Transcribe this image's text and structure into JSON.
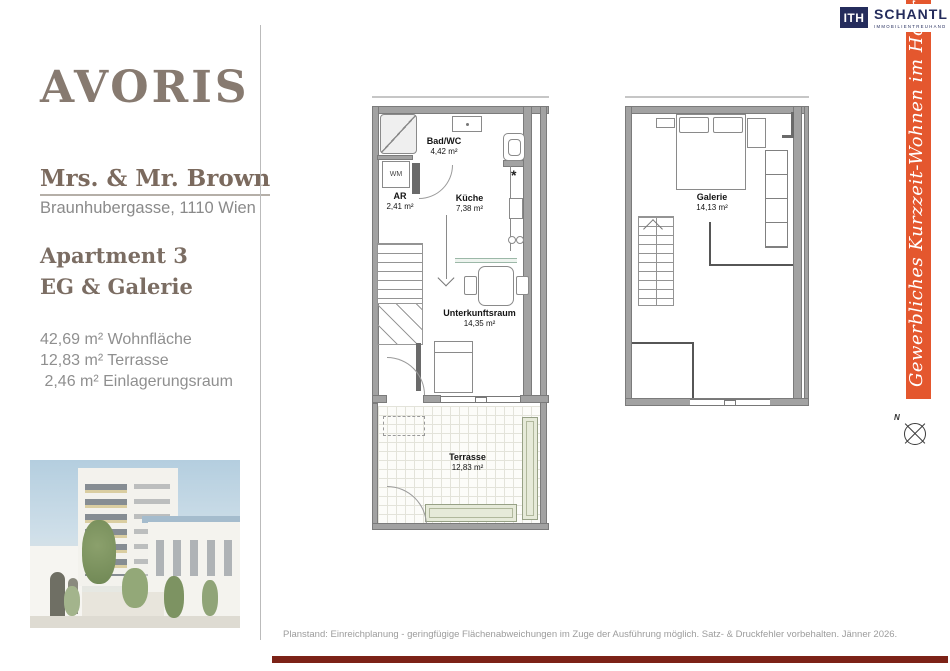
{
  "header": {
    "logo_text": "AVORIS",
    "client_name": "Mrs. & Mr. Brown",
    "address": "Braunhubergasse, 1110 Wien",
    "apartment_title": "Apartment 3",
    "level_title": "EG & Galerie",
    "area_lines": [
      "42,69 m² Wohnfläche",
      "12,83 m² Terrasse",
      " 2,46 m² Einlagerungsraum"
    ]
  },
  "partner": {
    "monogram": "ITH",
    "company": "SCHANTL",
    "tagline": "IMMOBILIENTREUHAND",
    "banner_text": "Gewerbliches Kurzzeit-Wohnen im Hoftrakt!",
    "banner_color": "#e4572e",
    "navy_color": "#242c5c"
  },
  "floorplans": {
    "eg": {
      "rooms": [
        {
          "name": "Bad/WC",
          "area": "4,42 m²"
        },
        {
          "name": "AR",
          "area": "2,41 m²"
        },
        {
          "name": "Küche",
          "area": "7,38 m²"
        },
        {
          "name": "Unterkunftsraum",
          "area": "14,35 m²"
        },
        {
          "name": "Terrasse",
          "area": "12,83 m²"
        }
      ],
      "labels": {
        "washing_machine": "WM",
        "tap_symbol": "*"
      }
    },
    "galerie": {
      "rooms": [
        {
          "name": "Galerie",
          "area": "14,13 m²"
        }
      ]
    }
  },
  "compass": {
    "north_label": "N"
  },
  "footer": {
    "disclaimer": "Planstand: Einreichplanung - geringfügige Flächenabweichungen im Zuge der Ausführung möglich. Satz- & Druckfehler vorbehalten. Jänner 2026.",
    "bar_color": "#7c2217"
  }
}
